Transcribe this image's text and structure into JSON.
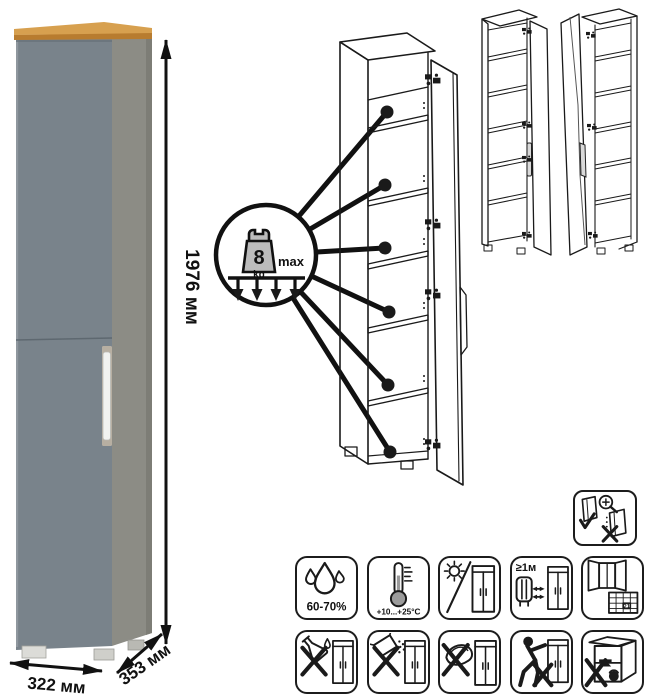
{
  "product_photo": {
    "dimensions": {
      "height": "1976 мм",
      "width": "322 мм",
      "depth": "353 мм"
    },
    "colors": {
      "door": "#79838b",
      "side": "#8c8c85",
      "side_edge": "#7d7d76",
      "top_wood": "#d7a04f",
      "top_wood_edge": "#b87c2f",
      "handle": "#f1f2f0",
      "handle_recess": "#b7afa2"
    }
  },
  "exploded_view": {
    "load_badge": {
      "value": "8",
      "unit": "kg",
      "qualifier": "max"
    },
    "pointed_shelves": 6,
    "drawing_door_fill": "#ffffff"
  },
  "variants": {
    "left": "door-hinged-right",
    "right": "door-hinged-left",
    "door_fill": "#9e9e9e"
  },
  "care_icons": {
    "row1": [
      {
        "name": "humidity-icon",
        "label": "60-70%"
      },
      {
        "name": "temperature-icon",
        "label": "+10...+25°C"
      },
      {
        "name": "no-direct-sunlight-icon",
        "label": ""
      },
      {
        "name": "heat-source-distance-icon",
        "label": "≥1м"
      },
      {
        "name": "ventilation-calendar-icon",
        "label": "21"
      }
    ],
    "row2": [
      {
        "name": "no-aggressive-liquids-icon"
      },
      {
        "name": "no-abrasive-powder-icon"
      },
      {
        "name": "no-scraper-icon"
      },
      {
        "name": "no-pushing-icon"
      },
      {
        "name": "no-overload-icon"
      }
    ],
    "door_adjustment": {
      "name": "door-adjustment-icon"
    }
  }
}
